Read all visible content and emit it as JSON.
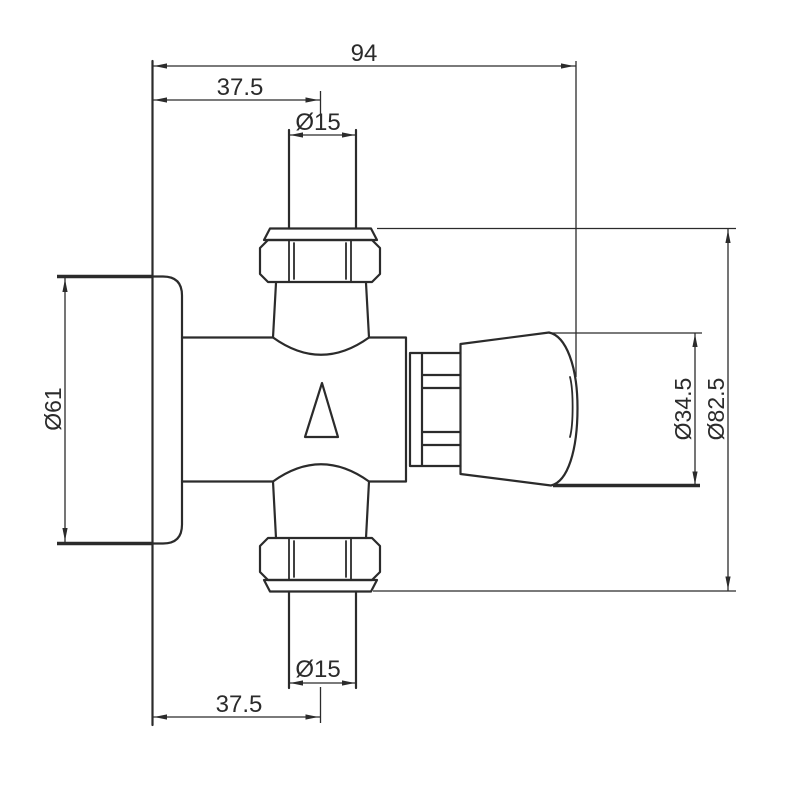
{
  "drawing": {
    "subject": "technical dimension drawing of a wall-mounted valve with flange, union nuts and control knob",
    "colors": {
      "background": "#ffffff",
      "line": "#2b2b2b",
      "text": "#2b2b2b"
    },
    "dims": {
      "overall_width": "94",
      "top_offset": "37.5",
      "top_pipe_dia": "Ø15",
      "flange_dia": "Ø61",
      "knob_dia": "Ø34.5",
      "overall_dia": "Ø82.5",
      "bottom_pipe_dia": "Ø15",
      "bottom_offset": "37.5"
    }
  }
}
